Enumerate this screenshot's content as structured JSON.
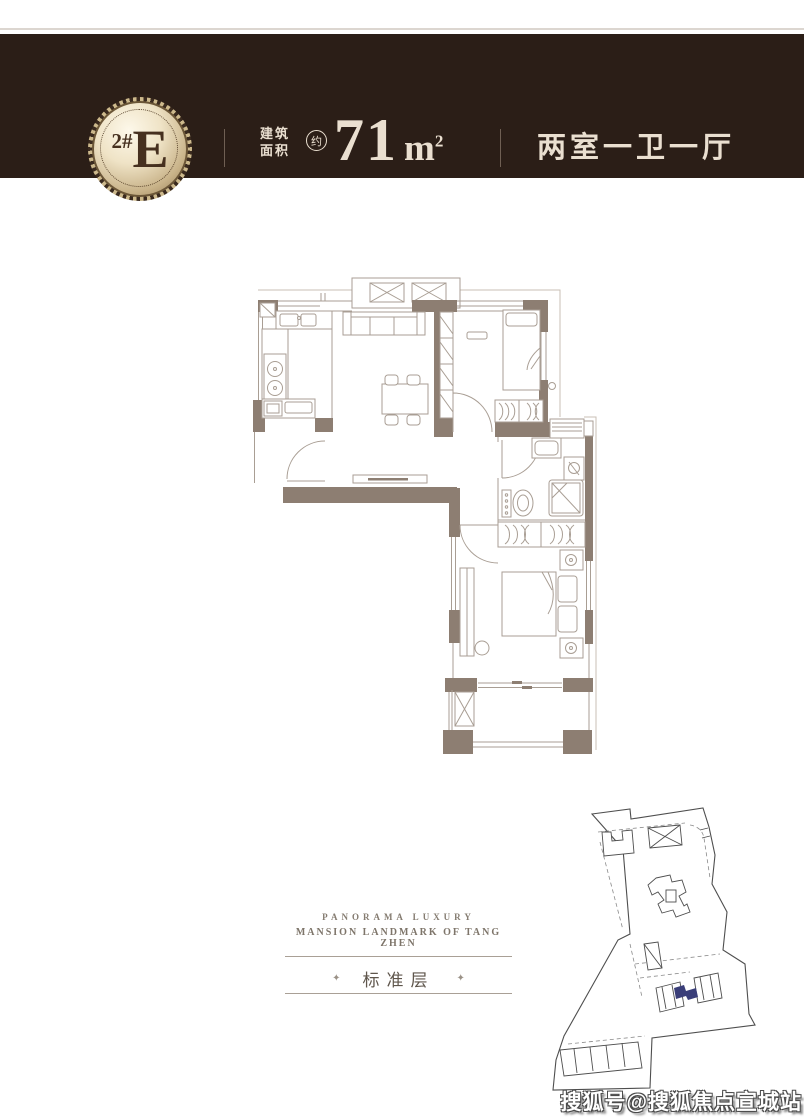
{
  "page": {
    "width": 804,
    "height": 1120,
    "background": "#FFFFFF"
  },
  "header": {
    "background": "#2B1E17",
    "text_color": "#EADFD0",
    "divider_color": "#6F5F53",
    "badge": {
      "unit": "2#",
      "type": "E",
      "gold_light": "#F7F0DE",
      "gold_dark": "#A58D62",
      "text_color": "#46301F"
    },
    "area": {
      "label_top": "建筑",
      "label_bottom": "面积",
      "approx": "约",
      "value": "71",
      "unit": "m",
      "power": "2"
    },
    "layout_text": "两室一卫一厅"
  },
  "floor_plan": {
    "wall_color": "#8D7E72",
    "furniture_line_color": "#A99E94",
    "outline_color": "#C9BFB4",
    "rooms": [
      "kitchen",
      "living-dining",
      "bedroom-1",
      "bathroom",
      "bedroom-2",
      "balcony"
    ]
  },
  "brand": {
    "title": "PANORAMA LUXURY",
    "subtitle": "MANSION LANDMARK OF TANG ZHEN",
    "floor_label": "标准层",
    "star": "✦",
    "text_color": "#857C71",
    "rule_color": "#A9A096"
  },
  "site_plan": {
    "line_color": "#4E4E4E",
    "highlight_color": "#3A3E79"
  },
  "watermark": {
    "text": "搜狐号@搜狐焦点宣城站",
    "color": "#FFFFFF"
  }
}
